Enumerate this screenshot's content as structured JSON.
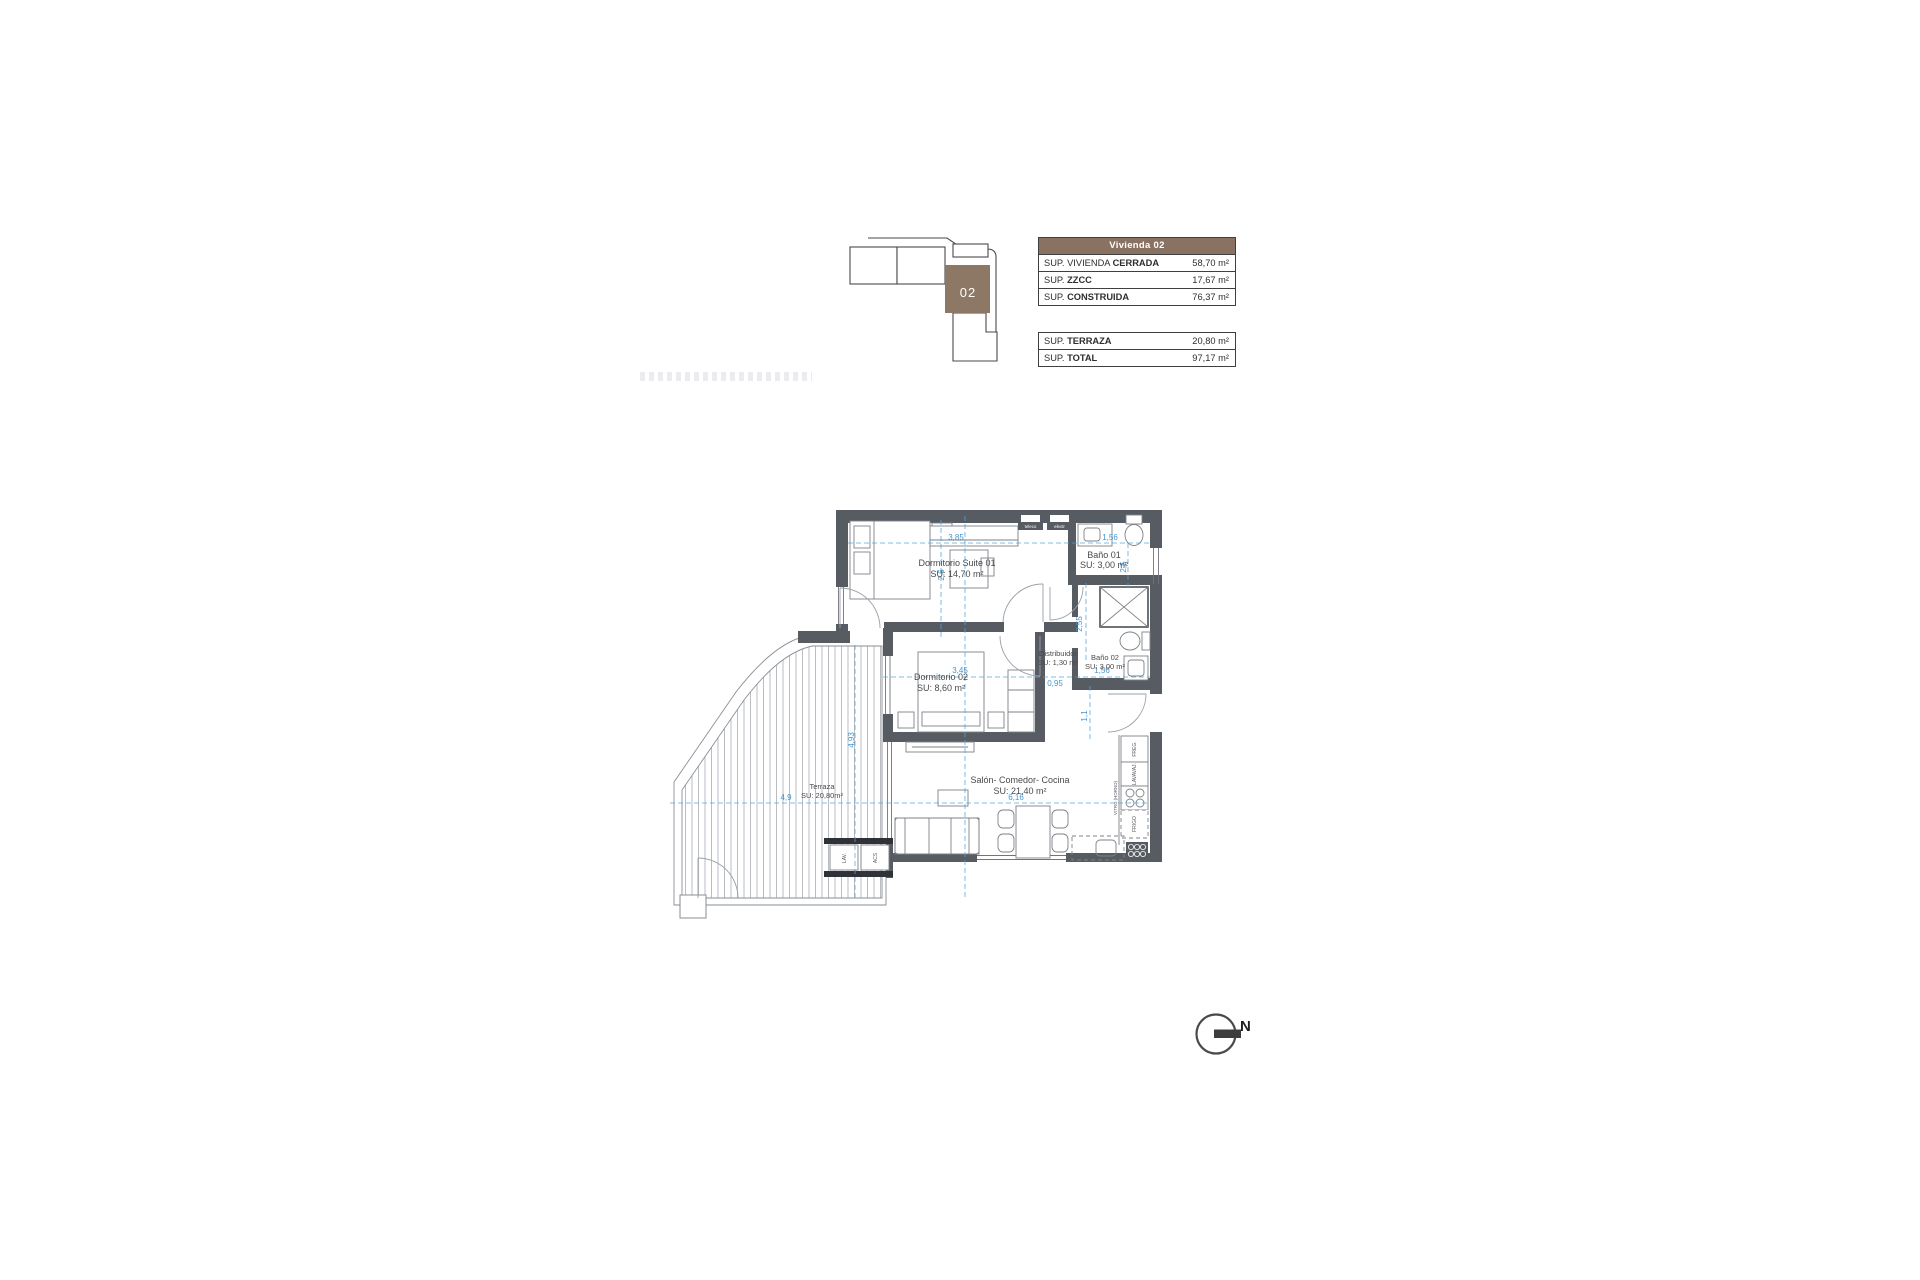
{
  "key_plan": {
    "unit": "02"
  },
  "summary": {
    "header": "Vivienda 02",
    "closed_table": [
      {
        "prefix": "SUP. VIVIENDA ",
        "bold": "CERRADA",
        "value": "58,70 m²"
      },
      {
        "prefix": "SUP. ",
        "bold": "ZZCC",
        "value": "17,67 m²"
      },
      {
        "prefix": "SUP. ",
        "bold": "CONSTRUIDA",
        "value": "76,37 m²"
      }
    ],
    "totals_table": [
      {
        "prefix": "SUP. ",
        "bold": "TERRAZA",
        "value": "20,80 m²"
      },
      {
        "prefix": "SUP. ",
        "bold": "TOTAL",
        "value": "97,17 m²"
      }
    ]
  },
  "plan": {
    "rooms": [
      {
        "name": "Dormitorio Suite 01",
        "su": "SU: 14,70 m²"
      },
      {
        "name": "Baño 01",
        "su": "SU: 3,00 m²"
      },
      {
        "name": "Distribuidor",
        "su": "SU: 1,30 m²"
      },
      {
        "name": "Baño 02",
        "su": "SU: 3,00 m²"
      },
      {
        "name": "Dormitorio 02",
        "su": "SU: 8,60 m²"
      },
      {
        "name": "Salón- Comedor- Cocina",
        "su": "SU: 21,40 m²"
      },
      {
        "name": "Terraza",
        "su": "SU: 20,80m²"
      }
    ],
    "dims": {
      "suite_w": "3,85",
      "suite_h": "2,6",
      "bano1_w": "1,56",
      "bano1_h": "2,5",
      "pasillo_h": "2,55",
      "dorm2_w": "3,45",
      "distrib_w": "0,95",
      "bano2_w": "1,56",
      "entrada_h": "1,1",
      "terraza_w": "4,9",
      "salon_w": "6,16",
      "terraza_h": "4,93"
    },
    "kitchen_units": [
      "FREG.",
      "LAVAVAJ.",
      "VITRO (HORNO)",
      "FRIGO"
    ],
    "utility_units": [
      "LAV.",
      "ACS"
    ],
    "cabinets": [
      "teleco",
      "electr"
    ]
  },
  "north": {
    "label": "N"
  },
  "colors": {
    "accent_brown": "#8a7262",
    "wall": "#575c63",
    "dim_blue": "#56a2d8"
  }
}
